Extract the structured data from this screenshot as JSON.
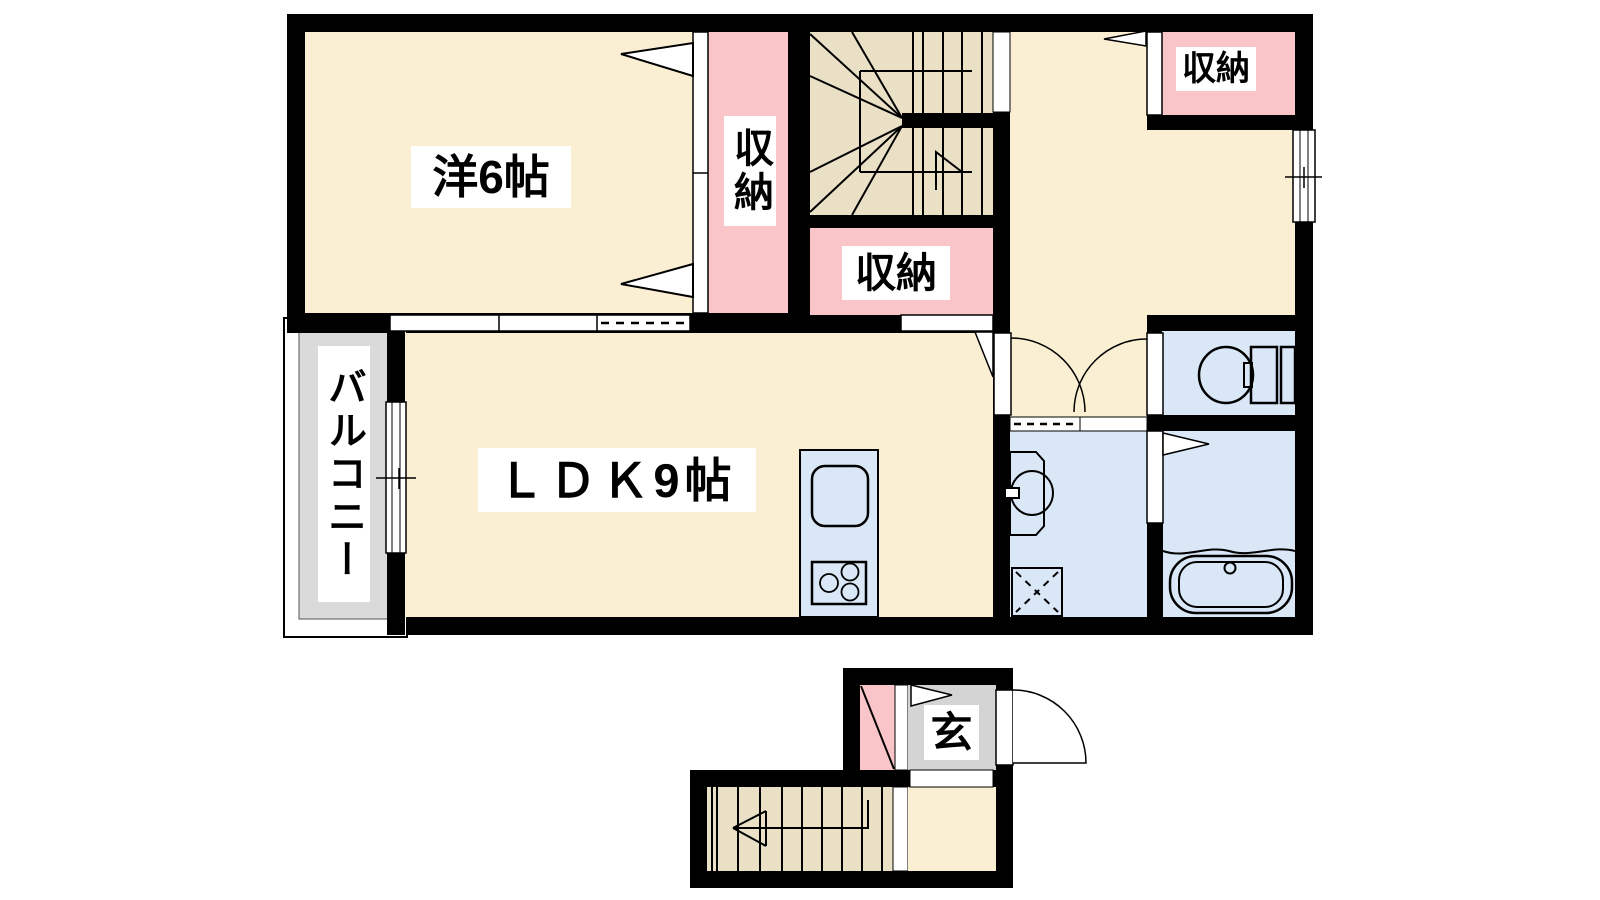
{
  "figure_type": "apartment-floor-plan",
  "palette": {
    "wall": "#000000",
    "room_floor": "#FBEFD3",
    "stairs_floor": "#EAE0C6",
    "closet_floor": "#FAC5C8",
    "wet_area_floor": "#D9E7F7",
    "balcony_floor": "#DADADA",
    "genkan_floor": "#D4D4D4",
    "opening": "#FFFFFF",
    "line": "#000000"
  },
  "rooms": {
    "western_room": {
      "label": "洋6帖"
    },
    "ldk": {
      "label": "ＬＤＫ9帖"
    },
    "closet_west": {
      "label": "収納"
    },
    "closet_center": {
      "label": "収納"
    },
    "closet_northeast": {
      "label": "収納"
    },
    "balcony": {
      "label": "バルコニー"
    },
    "entrance": {
      "label": "玄"
    }
  },
  "fixtures": [
    "winding-staircase-2f",
    "straight-staircase-1f",
    "kitchen-counter",
    "kitchen-sink",
    "gas-stove",
    "toilet",
    "wash-basin",
    "washing-machine-pan",
    "bathtub",
    "entry-door-swing",
    "interior-door-swings",
    "sliding-windows"
  ]
}
